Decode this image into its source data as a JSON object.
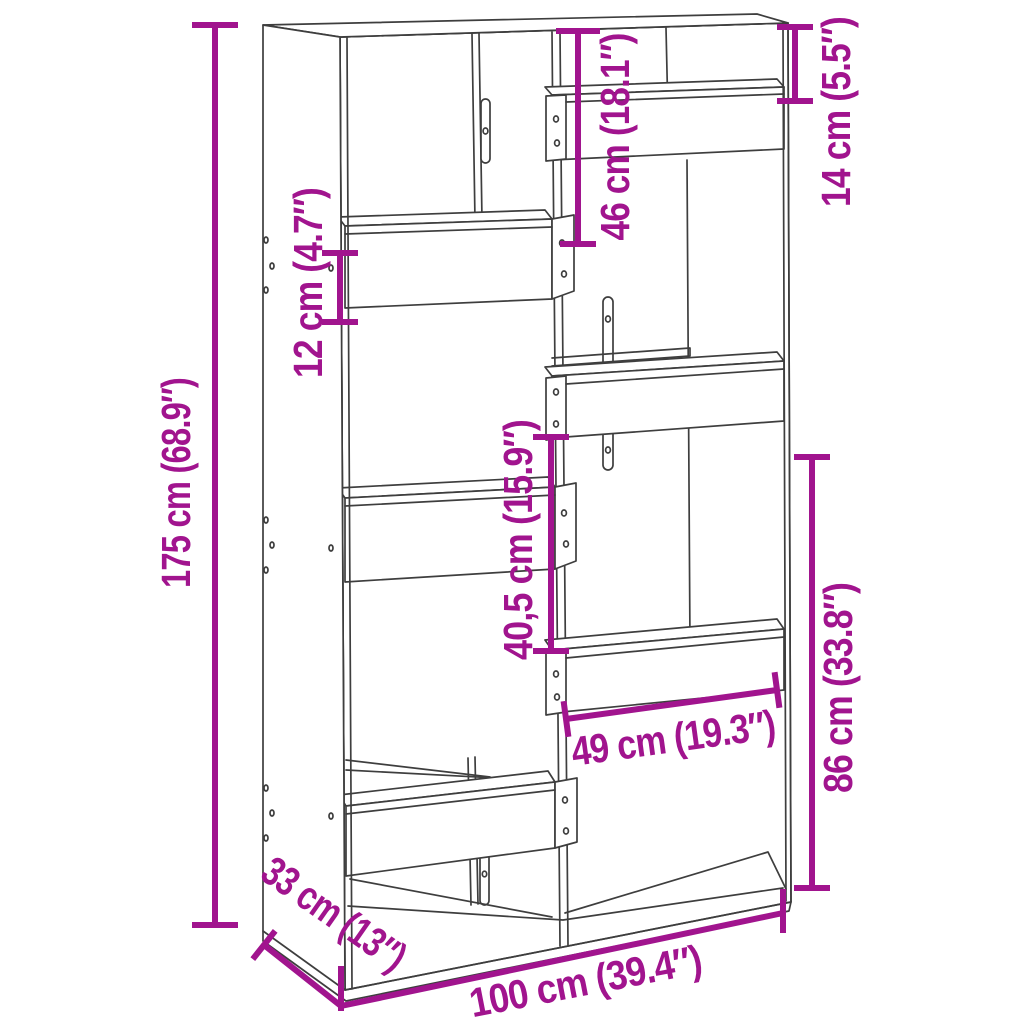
{
  "figure": {
    "kind": "furniture-dimension-diagram",
    "product": "bookcase room divider",
    "view": "perspective line drawing"
  },
  "colors": {
    "dimension_accent": "#A1148E",
    "outline": "#3E3E3E",
    "background": "#FFFFFF"
  },
  "dimensions": {
    "height": {
      "label": "175 cm (68.9″)"
    },
    "shelf_box": {
      "label": "12 cm (4.7″)"
    },
    "top_section": {
      "label": "46 cm (18.1″)"
    },
    "top_right_gap": {
      "label": "14 cm (5.5″)"
    },
    "middle_section": {
      "label": "40,5 cm (15.9″)"
    },
    "bottom_right": {
      "label": "86 cm (33.8″)"
    },
    "inner_width": {
      "label": "49 cm (19.3″)"
    },
    "depth": {
      "label": "33 cm (13″)"
    },
    "width": {
      "label": "100 cm (39.4″)"
    }
  }
}
